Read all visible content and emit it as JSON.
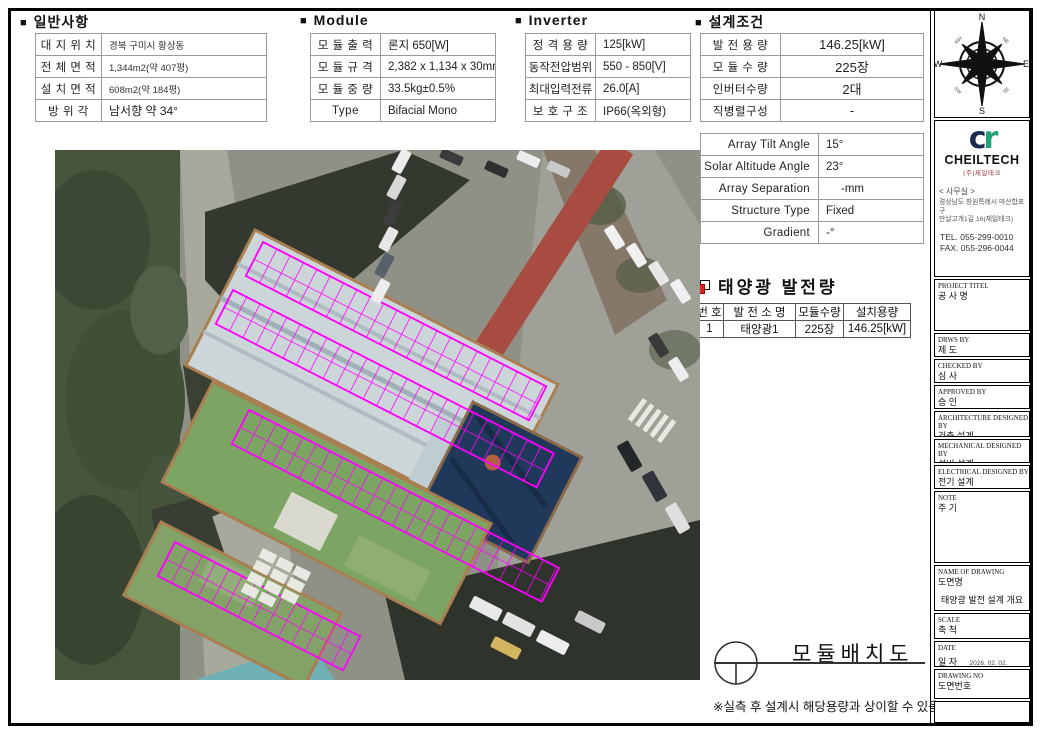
{
  "ui": {
    "bullet": "■"
  },
  "general": {
    "heading": "일반사항",
    "rows": [
      {
        "label": "대 지 위 치",
        "value": "경북 구미시 황상동"
      },
      {
        "label": "전 체 면 적",
        "value": "1,344m2(약 407평)"
      },
      {
        "label": "설 치 면 적",
        "value": "608m2(약 184평)"
      },
      {
        "label": "방  위  각",
        "value": "남서향 약 34°"
      }
    ]
  },
  "module": {
    "heading": "Module",
    "rows": [
      {
        "label": "모 듈 출 력",
        "value": "론지 650[W]"
      },
      {
        "label": "모 듈 규 격",
        "value": "2,382 x 1,134 x 30mm"
      },
      {
        "label": "모 듈 중 량",
        "value": "33.5kg±0.5%"
      },
      {
        "label": "Type",
        "value": "Bifacial Mono"
      }
    ]
  },
  "inverter": {
    "heading": "Inverter",
    "rows": [
      {
        "label": "정 격 용 량",
        "value": "125[kW]"
      },
      {
        "label": "동작전압범위",
        "value": "550 - 850[V]"
      },
      {
        "label": "최대입력전류",
        "value": "26.0[A]"
      },
      {
        "label": "보 호 구 조",
        "value": "IP66(옥외형)"
      }
    ]
  },
  "design": {
    "heading": "설계조건",
    "rows": [
      {
        "label": "발 전 용 량",
        "value": "146.25[kW]"
      },
      {
        "label": "모 듈 수 량",
        "value": "225장"
      },
      {
        "label": "인버터수량",
        "value": "2대"
      },
      {
        "label": "직병렬구성",
        "value": "-"
      }
    ],
    "rows2": [
      {
        "label": "Array Tilt Angle",
        "value": "15°"
      },
      {
        "label": "Solar Altitude Angle",
        "value": "23°"
      },
      {
        "label": "Array Separation",
        "value": "-mm"
      },
      {
        "label": "Structure Type",
        "value": "Fixed"
      },
      {
        "label": "Gradient",
        "value": "-°"
      }
    ]
  },
  "generation": {
    "heading": "태양광 발전량",
    "headers": [
      "번 호",
      "발 전 소 명",
      "모듈수량",
      "설치용량"
    ],
    "rows": [
      [
        "1",
        "태양광1",
        "225장",
        "146.25[kW]"
      ]
    ]
  },
  "drawing": {
    "title": "모듈배치도",
    "note": "※실측 후 설계시 해당용량과 상이할 수 있음."
  },
  "compass": {
    "n": "N",
    "e": "E",
    "s": "S",
    "w": "W",
    "ne": "NE",
    "se": "SE",
    "sw": "SW",
    "nw": "NW"
  },
  "company": {
    "logo_c": "c",
    "logo_r": "r",
    "name": "CHEILTECH",
    "sub": "(주)제일테크",
    "office": "< 사무실 >",
    "addr1": "경상남도 창원특례시 마산합포구",
    "addr2": "만날고개1길 16(제일테크)",
    "tel": "TEL. 055-299-0010",
    "fax": "FAX. 055-296-0044"
  },
  "titleblock": {
    "entries": [
      {
        "en": "PROJECT TITEL",
        "ko": "공 사 명",
        "value": ""
      },
      {
        "en": "DRWS BY",
        "ko": "제  도",
        "value": ""
      },
      {
        "en": "CHECKED BY",
        "ko": "심  사",
        "value": ""
      },
      {
        "en": "APPROVED BY",
        "ko": "승  인",
        "value": ""
      },
      {
        "en": "ARCHITECTURE DESIGNED BY",
        "ko": "건축 설계",
        "value": ""
      },
      {
        "en": "MECHANICAL DESIGNED BY",
        "ko": "설비 설계",
        "value": ""
      },
      {
        "en": "ELECTRICAL DESIGNED BY",
        "ko": "전기 설계",
        "value": ""
      },
      {
        "en": "NOTE",
        "ko": "주  기",
        "value": ""
      },
      {
        "en": "NAME OF DRAWING",
        "ko": "도면명",
        "value": "태양광 발전 설계 개요"
      },
      {
        "en": "SCALE",
        "ko": "축  척",
        "value": ""
      },
      {
        "en": "DATE",
        "ko": "일  자",
        "value": "2026. 02. 02."
      },
      {
        "en": "DRAWING NO",
        "ko": "도면번호",
        "value": ""
      }
    ]
  },
  "colors": {
    "panel_accent": "#ff00ff",
    "logo_navy": "#1b2b4d",
    "logo_green": "#21a07a",
    "red_icon": "#dd2222"
  }
}
